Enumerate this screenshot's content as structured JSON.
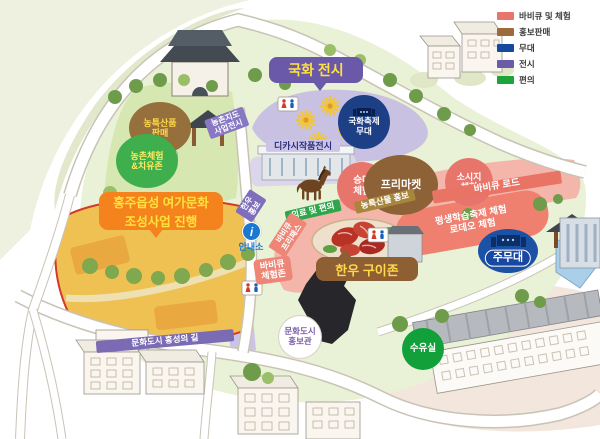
{
  "legend": {
    "items": [
      {
        "label": "바비큐 및 체험",
        "color": "#E8756B"
      },
      {
        "label": "홍보판매",
        "color": "#9C6B3B"
      },
      {
        "label": "무대",
        "color": "#164A9E"
      },
      {
        "label": "전시",
        "color": "#6A5CA8"
      },
      {
        "label": "편의",
        "color": "#1CA43B"
      }
    ]
  },
  "labels": {
    "gukhwa_exhibit": "국화 전시",
    "hongju_project": "홍주읍성 여가문화\n조성사업 진행",
    "hanwoo_grill_zone": "한우 구이존",
    "main_stage": "주무대",
    "mum_festival_stage": "국화축제\n무대",
    "nongteuk_sale": "농특산품\n판매",
    "nongchon_healing": "농촌체험\n&치유존",
    "nongchon_jido": "농촌지도\n사업전시",
    "dikasi_exhibit": "디카시작품전시",
    "horse_riding": "승마\n체험",
    "hanwoo_promo": "한우\n홍보",
    "medical_convenience": "의료 및 편의",
    "nongteuksanmul_promo": "농특산물 홍보",
    "bbq_freepass": "바비큐\n프리패스",
    "bbq_experience_zone": "바비큐\n체험존",
    "free_market": "프리마켓",
    "sausage_experience": "소시지\n체험",
    "bbq_road": "바비큐 로드",
    "lifelong_learning": "평생학습축제 체험\n로데오 체험",
    "info_booth": "안내소",
    "info_icon_glyph": "i",
    "culture_city_hall": "문화도시\n홍보관",
    "nursing_room": "수유실",
    "culture_city_road": "문화도시 홍성의 길"
  },
  "colors": {
    "bbq_zone": "#F4B6AA",
    "bbq_band": "#E97365",
    "exhibit_zone": "#C9C1E1",
    "stage_blue": "#1C52A6",
    "field_yellow": "#EFC153",
    "ground_green": "#E9F1D6",
    "bubble_orange": "#F4831D",
    "bubble_purple": "#6A58A8",
    "bubble_brown": "#8E5F33",
    "callout_text_yellow": "#FFE23C"
  }
}
